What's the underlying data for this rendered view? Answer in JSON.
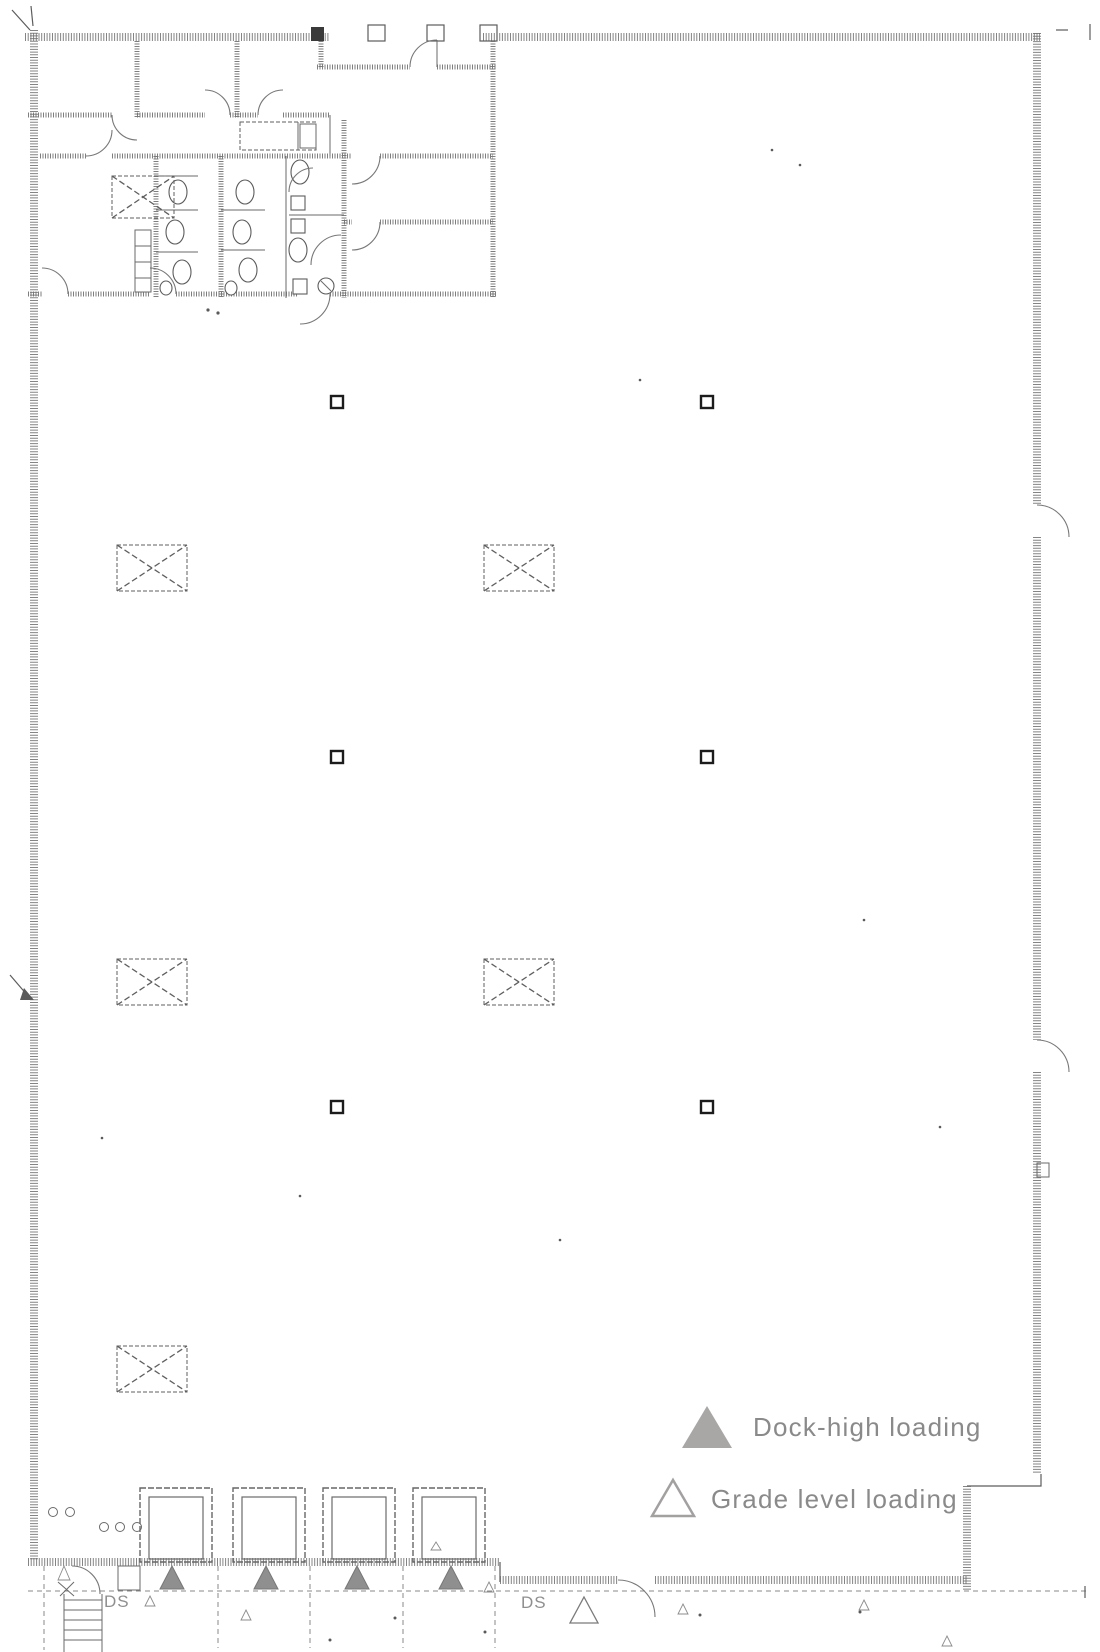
{
  "legend": {
    "items": [
      {
        "label": "Dock-high loading",
        "symbol": "dock-high-triangle",
        "fill": "#a9a6a6"
      },
      {
        "label": "Grade level loading",
        "symbol": "grade-level-triangle",
        "stroke": "#a3a0a0"
      }
    ],
    "text_color": "#8a8a8a"
  },
  "annotations": {
    "downspout_label_left": "DS",
    "downspout_label_right": "DS"
  },
  "palette": {
    "paper": "#ffffff",
    "ink": "#5c5c5c",
    "wall_gray": "#6f6f6f",
    "marker_fill": "#8f8f8f"
  },
  "plan_markers": {
    "square_columns": [
      {
        "x": 337,
        "y": 402
      },
      {
        "x": 707,
        "y": 402
      },
      {
        "x": 337,
        "y": 757
      },
      {
        "x": 707,
        "y": 757
      },
      {
        "x": 337,
        "y": 1107
      },
      {
        "x": 707,
        "y": 1107
      }
    ],
    "cross_braced_bays": [
      {
        "x": 152,
        "y": 568
      },
      {
        "x": 519,
        "y": 568
      },
      {
        "x": 152,
        "y": 982
      },
      {
        "x": 519,
        "y": 982
      },
      {
        "x": 152,
        "y": 1369
      }
    ],
    "dock_high_positions": [
      {
        "x": 172,
        "y": 1578
      },
      {
        "x": 266,
        "y": 1578
      },
      {
        "x": 357,
        "y": 1578
      },
      {
        "x": 451,
        "y": 1578
      }
    ],
    "grade_level_positions": [
      {
        "x": 584,
        "y": 1610
      }
    ]
  }
}
